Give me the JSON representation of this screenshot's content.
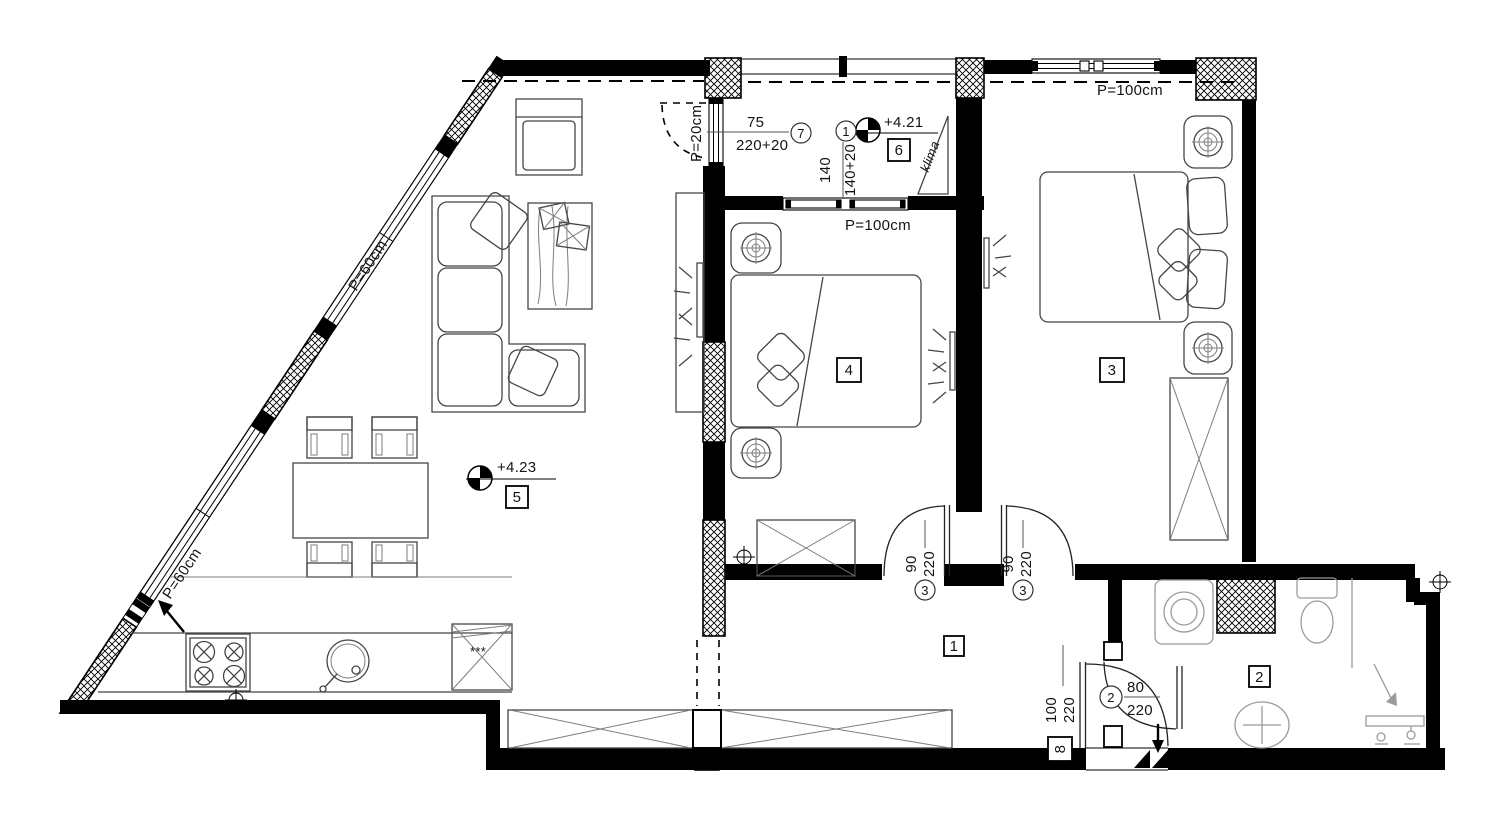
{
  "rooms": {
    "corridor": {
      "mark": "1"
    },
    "bathroom": {
      "mark": "2"
    },
    "bedroom_east": {
      "mark": "3"
    },
    "bedroom_center": {
      "mark": "4"
    },
    "living_room": {
      "mark": "5",
      "elevation": "+4.23"
    },
    "loggia": {
      "mark": "6",
      "elevation": "+4.21",
      "ac_unit": "klima"
    }
  },
  "windows": {
    "facade_upper": {
      "parapet": "P=60cm"
    },
    "facade_lower": {
      "parapet": "P=60cm"
    },
    "loggia_side": {
      "parapet": "P=20cm"
    },
    "loggia_front": {
      "parapet": "P=100cm",
      "width": "140",
      "width_total": "140+20",
      "mark": "1"
    },
    "bedroom_east_front": {
      "parapet": "P=100cm"
    }
  },
  "doors": {
    "loggia_door": {
      "width": "75",
      "height": "220+20",
      "mark": "7"
    },
    "bedroom_center_door": {
      "width": "90",
      "height": "220",
      "mark": "3"
    },
    "bedroom_east_door": {
      "width": "90",
      "height": "220",
      "mark": "3"
    },
    "bathroom_door": {
      "width": "80",
      "height": "220",
      "mark": "2"
    },
    "entrance_door": {
      "width": "100",
      "height": "220",
      "mark": "8"
    }
  },
  "kitchen": {
    "fridge_symbol": "***"
  },
  "icons": {
    "elevation_marker": "quadrant-filled-circle",
    "survey_marker": "cross-circle",
    "entrance_marker": "double-black-triangle",
    "entry_arrow": "down-arrow",
    "facade_arrow": "up-left-arrow"
  },
  "colors": {
    "wall": "#000000",
    "furniture": "#454545",
    "fixture": "#9b9b9b",
    "paper": "#ffffff"
  }
}
